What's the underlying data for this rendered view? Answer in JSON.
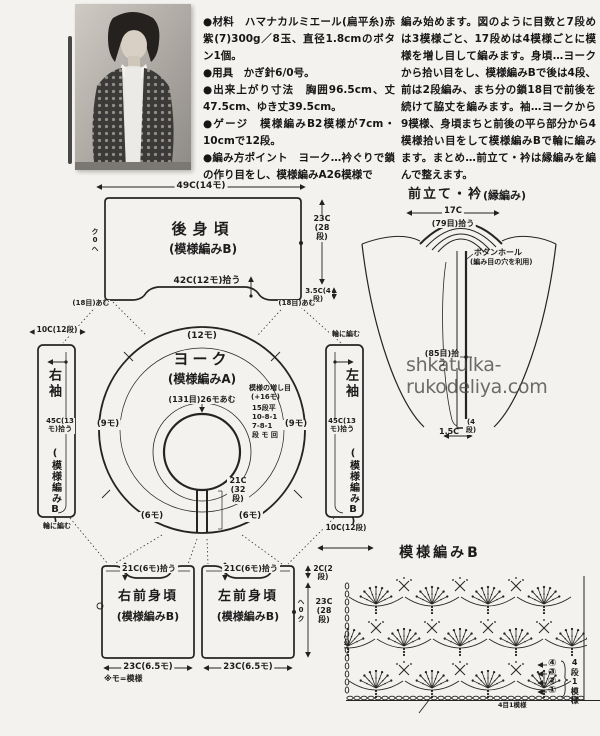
{
  "watermark": "shkatulka-rukodeliya.com",
  "intro": {
    "col1": "●材料　ハマナカルミエール(扁平糸)赤紫(7)300g／8玉、直径1.8cmのボタン1個。\n●用具　かぎ針6/0号。\n●出来上がり寸法　胸囲96.5cm、丈47.5cm、ゆき丈39.5cm。\n●ゲージ　模様編みB2模様が7cm・10cmで12段。\n●編み方ポイント　ヨーク…衿ぐりで鎖の作り目をし、模様編みA26模様で",
    "col2": "編み始めます。図のように目数と7段めは3模様ごと、17段めは4模様ごとに模様を増し目して編みます。身頃…ヨークから拾い目をし、模様編みBで後は4段、前は2段編み、まち分の鎖18目で前後を続けて脇丈を編みます。袖…ヨークから9模様、身頃まちと前後の平ら部分から4模様拾い目をして模様編みBで輪に編みます。まとめ…前立て・衿は縁編みを編んで整えます。"
  },
  "back": {
    "title": "後身頃",
    "pattern": "(模様編みB)",
    "width_top": "49C(14モ)",
    "pickup_bottom": "42C(12モ)拾う",
    "side": "23C(28段)",
    "hem": "3.5C(4段)",
    "corner_left": "(18目)あむ",
    "corner_right": "(18目)あむ",
    "edge_mark": "ク0ヘ"
  },
  "yoke": {
    "title": "ヨーク",
    "pattern": "(模様編みA)",
    "cast_on": "(131目)26モあむ",
    "arc_top": "(12モ)",
    "arc_left": "(9モ)",
    "arc_right": "(9モ)",
    "arc_bottom_left": "(6モ)",
    "arc_bottom_right": "(6モ)",
    "slit": "21C(32段)",
    "inc": {
      "title": "模様の増し目",
      "plus": "(+16モ)",
      "r1": "15段平",
      "r2": "10-8-1",
      "r3": "7-8-1",
      "cols": "段 モ 回"
    }
  },
  "sleeve_right": {
    "title": "右袖",
    "pickup": "45C(13モ)拾う",
    "pattern": "(模様編みB)",
    "width": "10C(12段)",
    "round": "輪に編む"
  },
  "sleeve_left": {
    "title": "左袖",
    "pickup": "45C(13モ)拾う",
    "pattern": "(模様編みB)",
    "width": "10C(12段)",
    "round": "輪に編む"
  },
  "fronts": {
    "right": {
      "title": "右前身頃",
      "pattern": "(模様編みB)",
      "top": "21C(6モ)拾う",
      "bottom": "23C(6.5モ)"
    },
    "left": {
      "title": "左前身頃",
      "pattern": "(模様編みB)",
      "top": "21C(6モ)拾う",
      "bottom": "23C(6.5モ)",
      "edge_mark": "ヘ0ク"
    },
    "side_top": "2C(2段)",
    "side": "23C(28段)",
    "note": "※モ=模様"
  },
  "band": {
    "title": "前立て・衿",
    "method": "(縁編み)",
    "neck_width": "17C",
    "neck_pickup": "(79目)拾う",
    "buttonhole": "ボタンホール",
    "buttonhole_note": "(編み目の穴を利用)",
    "front_pickup": "(85目)拾う",
    "width": "1.5C",
    "rows": "(4段)"
  },
  "stitch": {
    "title": "模様編みB",
    "unit_rows": "4段1模様",
    "unit_sts": "4目1模様",
    "row_numbers": [
      "④",
      "③",
      "②",
      "①"
    ]
  }
}
